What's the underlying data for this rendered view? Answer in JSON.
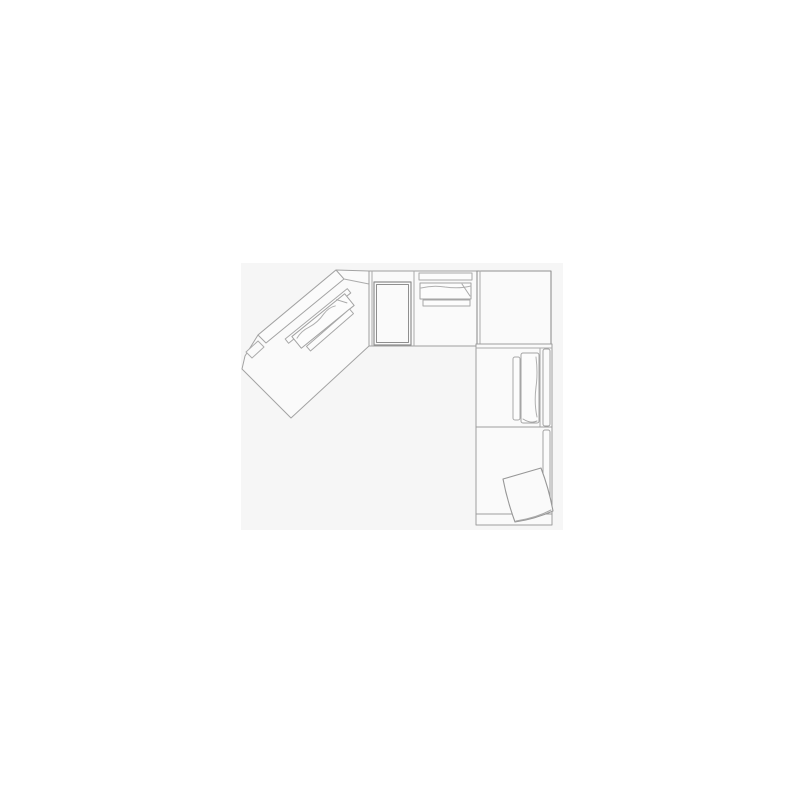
{
  "image": {
    "description": "Technical line drawing, top view floor plan of a corner sectional sofa with an angled chaise unit, console, corner unit, right units and a loose pillow",
    "background": "#ffffff",
    "panel": {
      "x": 241,
      "y": 263,
      "width": 322,
      "height": 267,
      "fill": "#f6f6f6"
    },
    "palette": {
      "line_light": "#a6a6a6",
      "line_medium": "#9d9d9d",
      "line_dark": "#8f8f8f",
      "unit_fill": "#fafafa",
      "cushion_fill": "#fcfcfc",
      "band_fill": "#fbfbfb"
    },
    "components": [
      "angled-chaise-unit",
      "top-armless-unit-with-console",
      "corner-unit",
      "right-armless-unit",
      "right-chaise-unit",
      "loose-pillow"
    ],
    "shapes": [
      {
        "name": "page-background",
        "type": "rect",
        "x": 0,
        "y": 0,
        "w": 800,
        "h": 800,
        "fill": "#ffffff"
      },
      {
        "name": "image-panel",
        "type": "rect",
        "x": 241,
        "y": 263,
        "w": 322,
        "h": 267,
        "fill": "#f6f6f6"
      },
      {
        "name": "wedge-unit-outline",
        "type": "polygon",
        "points": "369,271 336,270 258,335 245,356 242,369 291,418 369,346",
        "fill": "#fafafa",
        "stroke": "#a3a3a3",
        "sw": 1
      },
      {
        "name": "wedge-step-detail",
        "type": "polygon",
        "points": "246,352 258,341 264,347 252,358",
        "fill": "#fafafa",
        "stroke": "#ababab",
        "sw": 1
      },
      {
        "name": "wedge-backrest-band",
        "type": "polygon",
        "points": "336,270 344,279 266,343 258,335",
        "fill": "#fbfbfb",
        "stroke": "#a3a3a3",
        "sw": 1
      },
      {
        "name": "wedge-band-tip-line",
        "type": "line",
        "x1": 344,
        "y1": 279,
        "x2": 369,
        "y2": 284,
        "stroke": "#ababab",
        "sw": 1
      },
      {
        "name": "wedge-cushion-strip-1",
        "type": "rect",
        "x": 278,
        "y": 313.2,
        "w": 80,
        "h": 5.5,
        "transform": "rotate(-39 318 316)",
        "fill": "#fcfcfc",
        "stroke": "#a8a8a8",
        "sw": 1
      },
      {
        "name": "wedge-seat-cushion",
        "type": "rect",
        "x": 289,
        "y": 313.5,
        "w": 68,
        "h": 15,
        "transform": "rotate(-39 323 321)",
        "fill": "#fcfcfc",
        "stroke": "#a3a3a3",
        "sw": 1
      },
      {
        "name": "wedge-cushion-fold-line",
        "type": "path",
        "d": "M292,318 q8,-3 16,-1 q10,2 20,-1 q8,-2 14,1",
        "transform": "rotate(-39 323 321)",
        "fill": "none",
        "stroke": "#b0b0b0",
        "sw": 1
      },
      {
        "name": "wedge-cushion-corner-fold",
        "type": "path",
        "d": "M347,313 l6,9",
        "transform": "rotate(-39 323 321)",
        "fill": "none",
        "stroke": "#a8a8a8",
        "sw": 1
      },
      {
        "name": "wedge-cushion-strip-2",
        "type": "rect",
        "x": 301.5,
        "y": 327,
        "w": 57,
        "h": 6,
        "transform": "rotate(-41 330 330)",
        "fill": "#fcfcfc",
        "stroke": "#a8a8a8",
        "sw": 1
      },
      {
        "name": "top-unit-body",
        "type": "rect",
        "x": 369,
        "y": 271,
        "w": 108,
        "h": 75,
        "fill": "#fafafa",
        "stroke": "#9d9d9d",
        "sw": 1
      },
      {
        "name": "top-unit-left-double-line",
        "type": "line",
        "x1": 372,
        "y1": 271,
        "x2": 372,
        "y2": 346,
        "stroke": "#ababab",
        "sw": 1
      },
      {
        "name": "top-unit-divider-line",
        "type": "line",
        "x1": 414,
        "y1": 271,
        "x2": 414,
        "y2": 346,
        "stroke": "#ababab",
        "sw": 1
      },
      {
        "name": "console-outer",
        "type": "rect",
        "x": 374,
        "y": 282,
        "w": 37,
        "h": 63,
        "fill": "#fafafa",
        "stroke": "#8f8f8f",
        "sw": 1.2
      },
      {
        "name": "console-inner",
        "type": "rect",
        "x": 376.5,
        "y": 284.5,
        "w": 32,
        "h": 58,
        "fill": "none",
        "stroke": "#8f8f8f",
        "sw": 1
      },
      {
        "name": "top-backrest-strip",
        "type": "rect",
        "x": 419,
        "y": 273,
        "w": 53,
        "h": 7,
        "fill": "#fcfcfc",
        "stroke": "#a8a8a8",
        "sw": 1
      },
      {
        "name": "top-back-cushion",
        "type": "rect",
        "x": 420,
        "y": 283,
        "w": 51,
        "h": 16,
        "fill": "#fcfcfc",
        "stroke": "#a3a3a3",
        "sw": 1
      },
      {
        "name": "top-cushion-wave",
        "type": "path",
        "d": "M421,288 q12,-3 24,-1 q14,2 26,-1",
        "fill": "none",
        "stroke": "#b0b0b0",
        "sw": 1
      },
      {
        "name": "top-cushion-fold",
        "type": "path",
        "d": "M462,284 l8,12",
        "fill": "none",
        "stroke": "#a8a8a8",
        "sw": 1
      },
      {
        "name": "top-lower-strip",
        "type": "rect",
        "x": 423,
        "y": 300,
        "w": 47,
        "h": 6,
        "fill": "#fcfcfc",
        "stroke": "#a8a8a8",
        "sw": 1
      },
      {
        "name": "corner-unit-body",
        "type": "rect",
        "x": 477,
        "y": 271,
        "w": 74,
        "h": 73,
        "fill": "#fafafa",
        "stroke": "#909090",
        "sw": 1.1
      },
      {
        "name": "corner-unit-left-double-line",
        "type": "line",
        "x1": 480,
        "y1": 271,
        "x2": 480,
        "y2": 344,
        "stroke": "#ababab",
        "sw": 1
      },
      {
        "name": "right-upper-unit-body",
        "type": "rect",
        "x": 476,
        "y": 344,
        "w": 76,
        "h": 83,
        "fill": "#fafafa",
        "stroke": "#9d9d9d",
        "sw": 1
      },
      {
        "name": "right-upper-top-double-line",
        "type": "line",
        "x1": 476,
        "y1": 348,
        "x2": 552,
        "y2": 348,
        "stroke": "#ababab",
        "sw": 1
      },
      {
        "name": "right-upper-seat-line",
        "type": "line",
        "x1": 540,
        "y1": 348,
        "x2": 540,
        "y2": 427,
        "stroke": "#ababab",
        "sw": 1
      },
      {
        "name": "right-cushion-strip",
        "type": "rect",
        "x": 513,
        "y": 357,
        "w": 7,
        "h": 63,
        "rx": 2,
        "fill": "#fcfcfc",
        "stroke": "#a8a8a8",
        "sw": 1
      },
      {
        "name": "right-seat-cushion",
        "type": "rect",
        "x": 521,
        "y": 353,
        "w": 18,
        "h": 70,
        "rx": 2,
        "fill": "#fcfcfc",
        "stroke": "#a3a3a3",
        "sw": 1
      },
      {
        "name": "right-cushion-wave",
        "type": "path",
        "d": "M536,357 q2,16 0,30 q-2,16 1,30",
        "fill": "none",
        "stroke": "#b0b0b0",
        "sw": 1
      },
      {
        "name": "right-cushion-fold",
        "type": "path",
        "d": "M523,419 q8,5 14,2",
        "fill": "none",
        "stroke": "#a8a8a8",
        "sw": 1
      },
      {
        "name": "right-backrest-band-upper",
        "type": "rect",
        "x": 543,
        "y": 349,
        "w": 7,
        "h": 77,
        "rx": 2,
        "fill": "#fbfbfb",
        "stroke": "#a3a3a3",
        "sw": 1
      },
      {
        "name": "right-lower-unit-body",
        "type": "rect",
        "x": 476,
        "y": 427,
        "w": 76,
        "h": 98,
        "fill": "#fafafa",
        "stroke": "#9d9d9d",
        "sw": 1
      },
      {
        "name": "right-backrest-band-lower",
        "type": "rect",
        "x": 543,
        "y": 430,
        "w": 7,
        "h": 83,
        "rx": 2,
        "fill": "#fbfbfb",
        "stroke": "#a3a3a3",
        "sw": 1
      },
      {
        "name": "bottom-front-band-line",
        "type": "line",
        "x1": 476,
        "y1": 514,
        "x2": 552,
        "y2": 514,
        "stroke": "#9d9d9d",
        "sw": 1
      },
      {
        "name": "loose-pillow",
        "type": "path",
        "d": "M503,479 L541,468 Q549,489 553,511 Q535,519 515,522 Q507,500 503,479 Z",
        "fill": "#fafafa",
        "stroke": "#979797",
        "sw": 1.1
      },
      {
        "name": "pillow-edge-detail",
        "type": "path",
        "d": "M516,521 q20,-3 35,-11",
        "fill": "none",
        "stroke": "#a8a8a8",
        "sw": 1
      }
    ]
  }
}
